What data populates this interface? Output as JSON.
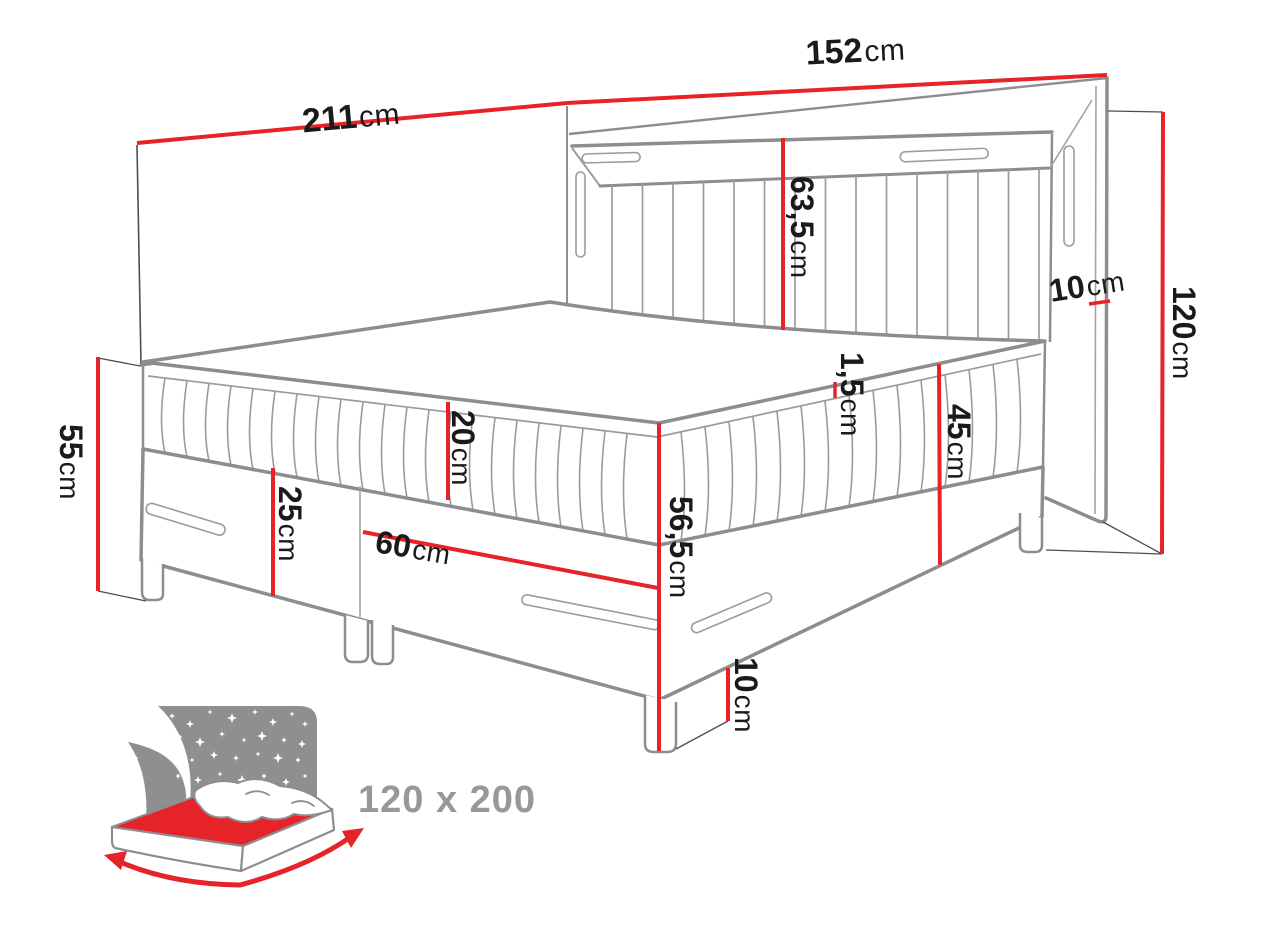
{
  "diagram_title": "bed-dimension-diagram",
  "dimensions": {
    "width_total": {
      "value": "211",
      "unit": "cm"
    },
    "headboard_width": {
      "value": "152",
      "unit": "cm"
    },
    "headboard_panel_height": {
      "value": "63,5",
      "unit": "cm"
    },
    "frame_margin": {
      "value": "10",
      "unit": "cm"
    },
    "headboard_height": {
      "value": "120",
      "unit": "cm"
    },
    "side_height": {
      "value": "55",
      "unit": "cm"
    },
    "mattress_height": {
      "value": "20",
      "unit": "cm"
    },
    "base_height": {
      "value": "25",
      "unit": "cm"
    },
    "drawer_width": {
      "value": "60",
      "unit": "cm"
    },
    "topper_height": {
      "value": "1,5",
      "unit": "cm"
    },
    "base_mattress_height": {
      "value": "45",
      "unit": "cm"
    },
    "bed_height": {
      "value": "56,5",
      "unit": "cm"
    },
    "leg_height": {
      "value": "10",
      "unit": "cm"
    }
  },
  "icon": {
    "size_label": "120 x 200"
  },
  "colors": {
    "dimension_red": "#e62329",
    "outline_gray": "#8d8d8f",
    "label_black": "#1a1a1a",
    "icon_gray": "#8f8f91",
    "icon_text_gray": "#98989a"
  }
}
